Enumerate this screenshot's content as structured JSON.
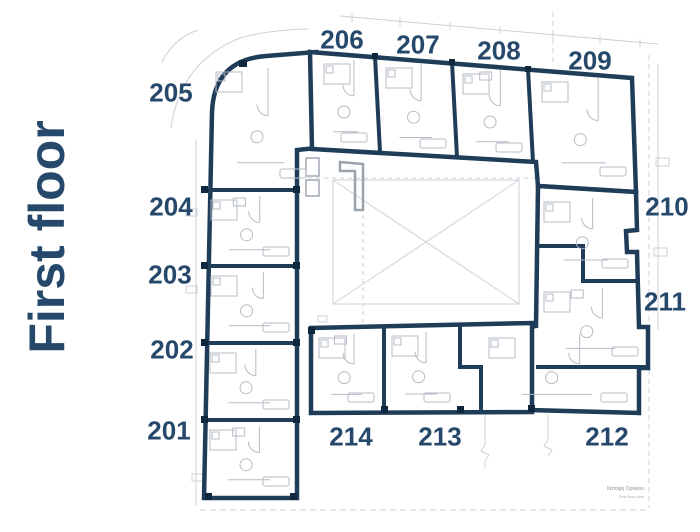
{
  "title": "First floor",
  "units": [
    {
      "id": "u205",
      "label": "205"
    },
    {
      "id": "u206",
      "label": "206"
    },
    {
      "id": "u207",
      "label": "207"
    },
    {
      "id": "u208",
      "label": "208"
    },
    {
      "id": "u209",
      "label": "209"
    },
    {
      "id": "u210",
      "label": "210"
    },
    {
      "id": "u211",
      "label": "211"
    },
    {
      "id": "u212",
      "label": "212"
    },
    {
      "id": "u213",
      "label": "213"
    },
    {
      "id": "u214",
      "label": "214"
    },
    {
      "id": "u204",
      "label": "204"
    },
    {
      "id": "u203",
      "label": "203"
    },
    {
      "id": "u202",
      "label": "202"
    },
    {
      "id": "u201",
      "label": "201"
    }
  ],
  "caption": {
    "line1": "Κάτοψη Ορόφου",
    "line2": "First floor plan"
  },
  "colors": {
    "wall_navy": "#1f3d58",
    "label_navy": "#26496b",
    "detail_gray": "#b5bbc4",
    "site_gray": "#ccd1d8"
  }
}
